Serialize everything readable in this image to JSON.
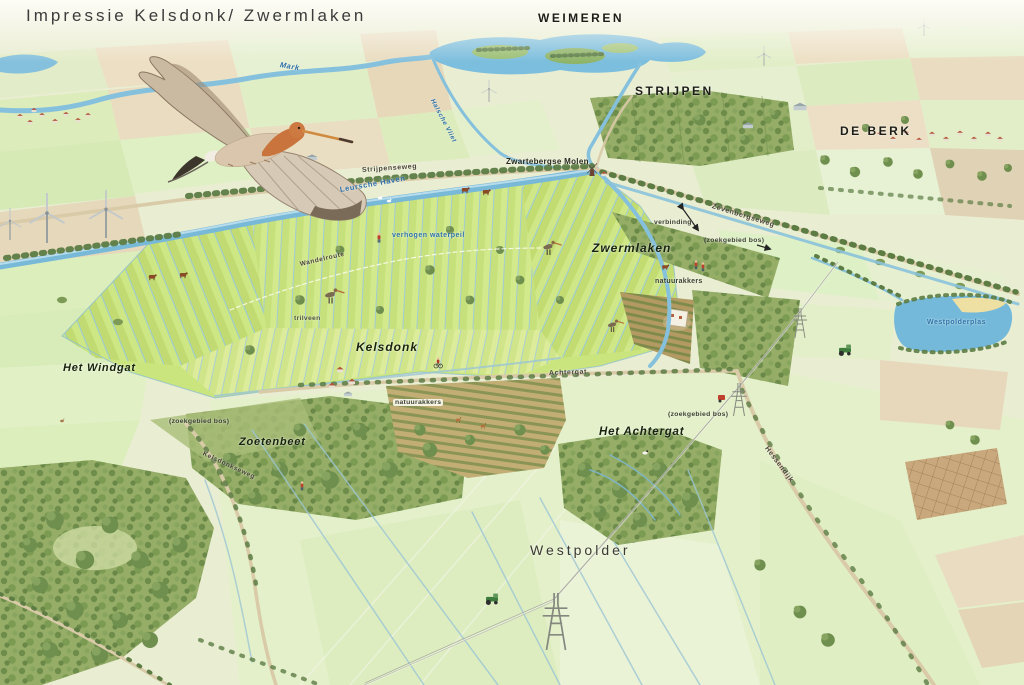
{
  "title": "Impressie Kelsdonk/ Zwermlaken",
  "labels": {
    "weimeren": "WEIMEREN",
    "mark": "Mark",
    "halsche_vliet": "Halsche Vliet",
    "strijpen": "STRIJPEN",
    "de_berk": "DE BERK",
    "zwartebergse_molen": "Zwartebergse Molen",
    "strijpenseweg": "Strijpenseweg",
    "leursche_haven": "Leursche Haven",
    "zevenbergseweg": "Zevenbergseweg",
    "verbinding": "verbinding",
    "zwermlaken": "Zwermlaken",
    "zoekgebied_bos_ne": "(zoekgebied bos)",
    "verhogen_waterpeil": "verhogen waterpeil",
    "wandelroute": "Wandelroute",
    "trilveen": "trilveen",
    "natuurakkers_noord": "natuurakkers",
    "westpolderplas": "Westpolderplas",
    "kelsdonk": "Kelsdonk",
    "het_windgat": "Het Windgat",
    "achtergat_weg": "Achtergat",
    "natuurakkers_zuid": "natuurakkers",
    "zoetenbeet": "Zoetenbeet",
    "zoekgebied_bos_west": "(zoekgebied bos)",
    "zoekgebied_bos_oost": "(zoekgebied bos)",
    "het_achtergat": "Het Achtergat",
    "kelsdonkseweg": "Kelsdonkseweg",
    "hessendijk": "Hessendijk",
    "westpolder": "Westpolder"
  },
  "icons": [
    "flying-godwit-icon",
    "standing-godwit-icon",
    "wind-turbine-icon",
    "windmill-icon",
    "power-pylon-icon",
    "cow-icon",
    "swan-icon",
    "goose-icon",
    "hare-icon",
    "deer-icon",
    "tractor-icon",
    "hiker-icon",
    "cyclist-icon",
    "house-icon",
    "barn-icon",
    "tree-icon"
  ],
  "palette": {
    "water": "#79b9d8",
    "wet_meadow": "#cbe57e",
    "forest": "#6f8f4f",
    "field_green": "#e3efc8",
    "field_tan": "#e9dcc0",
    "label_blue": "#2d6fa8",
    "label_dark": "#1d1d18"
  }
}
